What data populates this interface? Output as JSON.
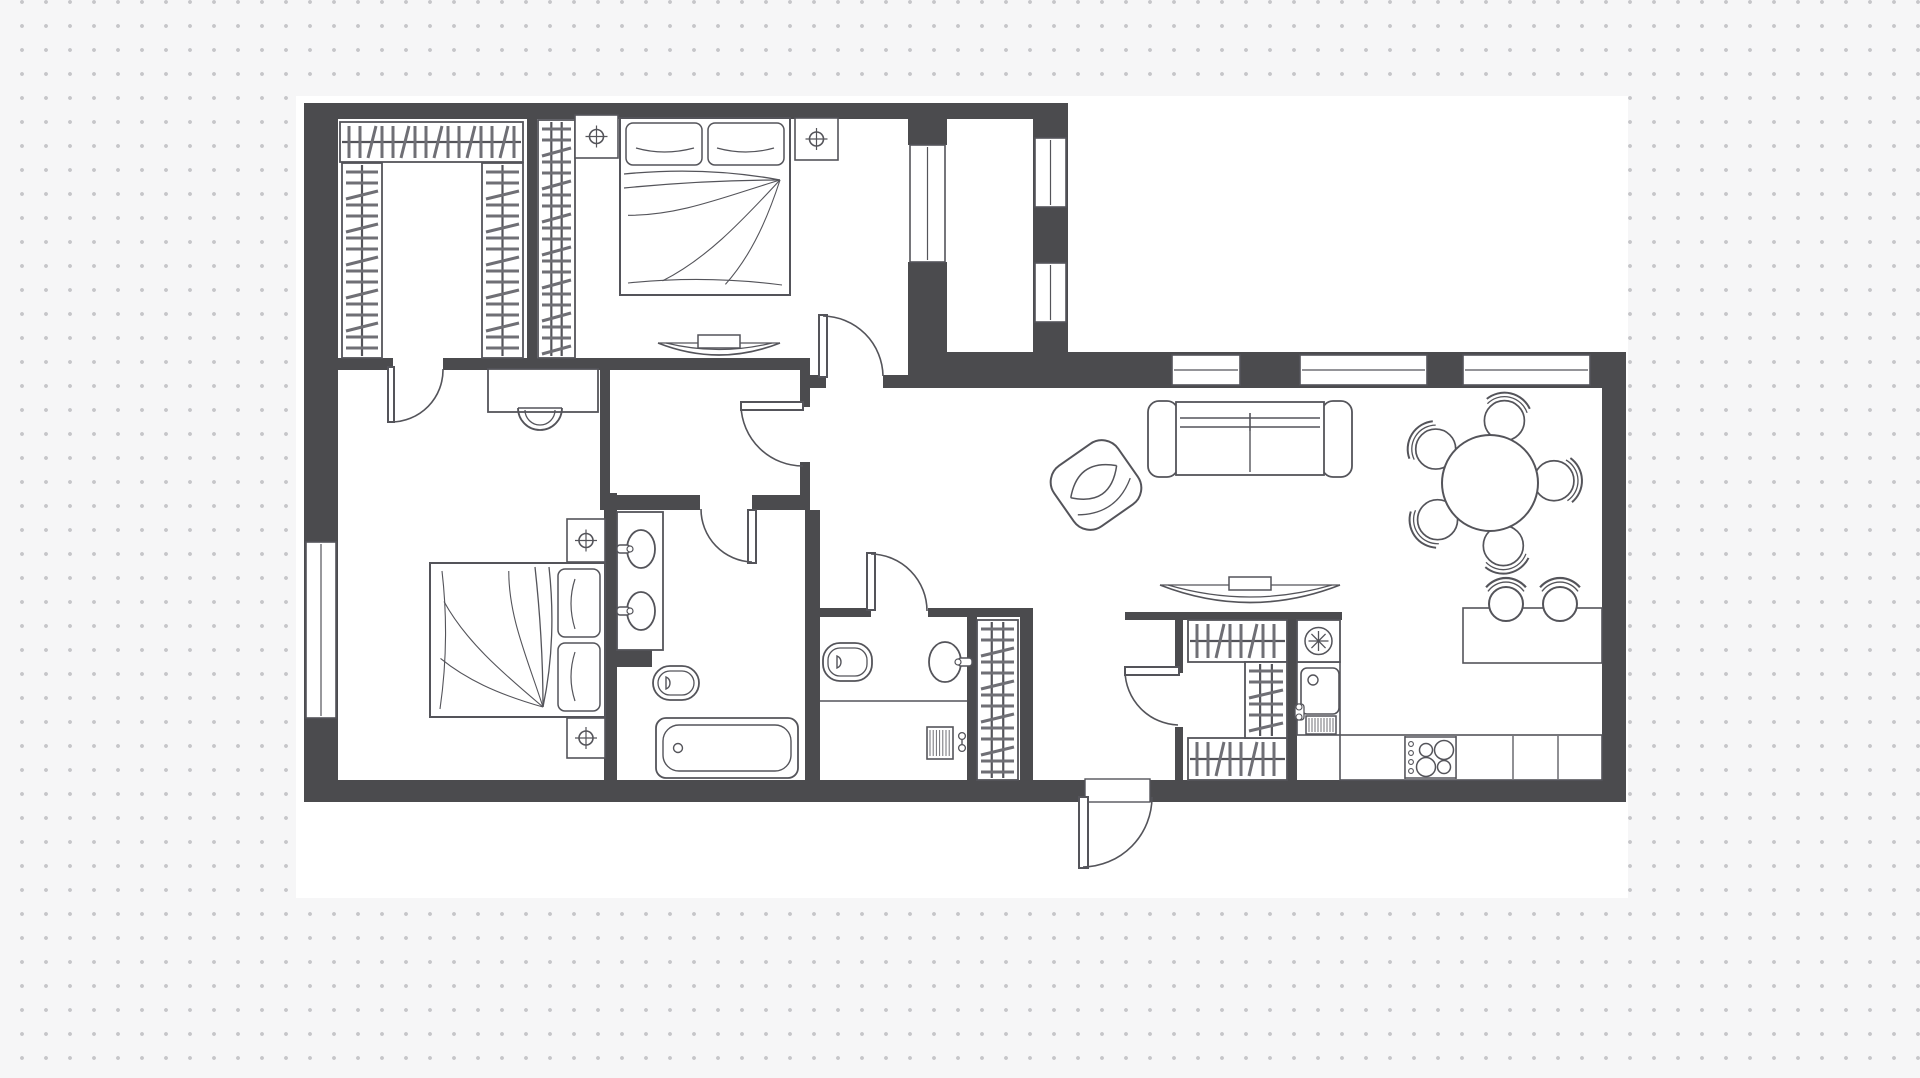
{
  "colors": {
    "background": "#f6f6f7",
    "dot": "#c6c6c9",
    "canvas": "#ffffff",
    "wall": "#4b4b4e",
    "line": "#54545a",
    "hatch": "#6f6f75"
  },
  "plan": {
    "canvas": [
      296,
      96,
      1332,
      802
    ],
    "walls": [
      [
        304,
        103,
        764,
        16
      ],
      [
        304,
        103,
        34,
        699
      ],
      [
        304,
        780,
        781,
        22
      ],
      [
        1150,
        780,
        476,
        22
      ],
      [
        1602,
        352,
        24,
        450
      ],
      [
        908,
        352,
        718,
        36
      ],
      [
        1033,
        119,
        35,
        233
      ],
      [
        908,
        119,
        39,
        26
      ],
      [
        908,
        262,
        39,
        96
      ],
      [
        338,
        358,
        55,
        12
      ],
      [
        443,
        358,
        367,
        12
      ],
      [
        810,
        375,
        16,
        13
      ],
      [
        883,
        375,
        25,
        13
      ],
      [
        800,
        370,
        10,
        37
      ],
      [
        800,
        462,
        10,
        48
      ],
      [
        527,
        119,
        10,
        239
      ],
      [
        600,
        370,
        10,
        125
      ],
      [
        604,
        493,
        13,
        289
      ],
      [
        600,
        495,
        100,
        15
      ],
      [
        752,
        495,
        58,
        15
      ],
      [
        805,
        510,
        15,
        270
      ],
      [
        607,
        648,
        45,
        19
      ],
      [
        820,
        608,
        51,
        9
      ],
      [
        928,
        608,
        105,
        9
      ],
      [
        967,
        617,
        10,
        163
      ],
      [
        1020,
        617,
        13,
        163
      ],
      [
        1125,
        612,
        217,
        8
      ],
      [
        1175,
        620,
        8,
        53
      ],
      [
        1175,
        727,
        8,
        53
      ],
      [
        1287,
        620,
        10,
        160
      ]
    ],
    "windows": [
      {
        "name": "window-left-bedroom",
        "rect": [
          306,
          542,
          30,
          176
        ],
        "axis": "v"
      },
      {
        "name": "window-bedroom-balcony",
        "rect": [
          910,
          145,
          35,
          117
        ],
        "axis": "v"
      },
      {
        "name": "window-balcony-upper",
        "rect": [
          1035,
          138,
          31,
          69
        ],
        "axis": "v"
      },
      {
        "name": "window-balcony-lower",
        "rect": [
          1035,
          263,
          31,
          59
        ],
        "axis": "v"
      },
      {
        "name": "window-living-1",
        "rect": [
          1172,
          355,
          68,
          30
        ],
        "axis": "h"
      },
      {
        "name": "window-living-2",
        "rect": [
          1300,
          355,
          127,
          30
        ],
        "axis": "h"
      },
      {
        "name": "window-living-3",
        "rect": [
          1463,
          355,
          127,
          30
        ],
        "axis": "h"
      }
    ],
    "opening": {
      "name": "entrance-threshold",
      "rect": [
        1085,
        779,
        65,
        23
      ]
    },
    "doors": [
      {
        "name": "door-walkin-closet",
        "leaf": [
          388,
          367,
          6,
          55
        ],
        "arc": [
          391,
          422,
          52,
          443,
          369,
          0
        ]
      },
      {
        "name": "door-master-bedroom",
        "leaf": [
          819,
          315,
          8,
          62
        ],
        "arc": [
          823,
          316,
          61,
          883,
          376,
          1
        ]
      },
      {
        "name": "door-vestibule",
        "leaf": [
          741,
          402,
          62,
          8
        ],
        "arc": [
          741,
          406,
          62,
          803,
          466,
          0
        ]
      },
      {
        "name": "door-bathroom",
        "leaf": [
          748,
          510,
          8,
          53
        ],
        "arc": [
          752,
          562,
          53,
          701,
          509,
          1
        ]
      },
      {
        "name": "door-wc",
        "leaf": [
          867,
          553,
          8,
          57
        ],
        "arc": [
          871,
          554,
          57,
          927,
          611,
          1
        ]
      },
      {
        "name": "door-storage",
        "leaf": [
          1125,
          667,
          54,
          8
        ],
        "arc": [
          1125,
          671,
          55,
          1178,
          725,
          0
        ]
      },
      {
        "name": "door-entrance",
        "leaf": [
          1079,
          797,
          9,
          71
        ],
        "arc": [
          1083,
          867,
          70,
          1152,
          797,
          0
        ]
      }
    ],
    "furniture": [
      {
        "type": "shelf",
        "name": "closet-shelf-top",
        "rect": [
          340,
          122,
          183,
          40
        ],
        "axis": "h",
        "rails": 1
      },
      {
        "type": "shelf",
        "name": "closet-shelf-left",
        "rect": [
          342,
          163,
          40,
          195
        ],
        "axis": "v",
        "rails": 1
      },
      {
        "type": "shelf",
        "name": "closet-shelf-right",
        "rect": [
          482,
          163,
          41,
          195
        ],
        "axis": "v",
        "rails": 1
      },
      {
        "type": "shelf",
        "name": "master-wardrobe",
        "rect": [
          538,
          120,
          37,
          238
        ],
        "axis": "v",
        "rails": 2
      },
      {
        "type": "shelf",
        "name": "hall-wardrobe",
        "rect": [
          977,
          620,
          41,
          160
        ],
        "axis": "v",
        "rails": 2
      },
      {
        "type": "shelf",
        "name": "storage-shelf-top",
        "rect": [
          1188,
          620,
          99,
          42
        ],
        "axis": "h",
        "rails": 1
      },
      {
        "type": "shelf",
        "name": "storage-shelf-bottom",
        "rect": [
          1188,
          738,
          99,
          42
        ],
        "axis": "h",
        "rails": 1
      },
      {
        "type": "shelf",
        "name": "storage-shelf-mid",
        "rect": [
          1245,
          662,
          42,
          76
        ],
        "axis": "v",
        "rails": 2
      },
      {
        "type": "bed",
        "name": "bed-master",
        "rect": [
          620,
          118,
          170,
          177
        ],
        "rot": 0
      },
      {
        "type": "bed",
        "name": "bed-second",
        "rect": [
          430,
          563,
          175,
          154
        ],
        "rot": 90
      },
      {
        "type": "nightstand",
        "name": "nightstand",
        "rect": [
          575,
          115,
          43,
          43
        ]
      },
      {
        "type": "nightstand",
        "name": "nightstand",
        "rect": [
          795,
          118,
          43,
          42
        ]
      },
      {
        "type": "nightstand",
        "name": "nightstand",
        "rect": [
          567,
          519,
          38,
          43
        ]
      },
      {
        "type": "nightstand",
        "name": "nightstand",
        "rect": [
          567,
          718,
          38,
          40
        ]
      },
      {
        "type": "desk",
        "name": "desk",
        "rect": [
          488,
          369,
          110,
          43
        ]
      },
      {
        "type": "deskchair",
        "name": "desk-chair",
        "cx": 540,
        "cy": 412,
        "r": 22
      },
      {
        "type": "console",
        "name": "tv-console-bedroom",
        "rect": [
          658,
          338,
          122,
          19
        ]
      },
      {
        "type": "console",
        "name": "tv-console-living",
        "rect": [
          1160,
          580,
          180,
          30
        ]
      },
      {
        "type": "sofa",
        "name": "sofa",
        "rect": [
          1148,
          400,
          204,
          78
        ]
      },
      {
        "type": "armchair",
        "name": "armchair",
        "cx": 1096,
        "cy": 485,
        "rot": -35
      },
      {
        "type": "dining",
        "name": "dining-table",
        "cx": 1490,
        "cy": 483,
        "r": 48,
        "chairs": [
          283,
          212,
          358,
          145,
          78
        ]
      },
      {
        "type": "vanity",
        "name": "bathroom-vanity",
        "rect": [
          617,
          512,
          46,
          138
        ]
      },
      {
        "type": "bidet",
        "name": "bidet",
        "rect": [
          653,
          666,
          46,
          34
        ]
      },
      {
        "type": "tub",
        "name": "bathtub",
        "rect": [
          656,
          718,
          142,
          60
        ]
      },
      {
        "type": "toilet",
        "name": "toilet",
        "rect": [
          823,
          643,
          49,
          38
        ]
      },
      {
        "type": "basin",
        "name": "wc-basin",
        "cx": 945,
        "cy": 662,
        "rx": 16,
        "ry": 20
      },
      {
        "type": "hline",
        "name": "wc-floor-line",
        "pts": [
          820,
          701,
          967,
          701
        ]
      },
      {
        "type": "washer",
        "name": "washer-hookup",
        "rect": [
          927,
          727,
          26,
          32
        ]
      },
      {
        "type": "counter",
        "name": "kitchen-counter-left",
        "rect": [
          1297,
          662,
          43,
          73
        ],
        "divs": []
      },
      {
        "type": "fridge",
        "name": "fridge",
        "rect": [
          1297,
          620,
          43,
          42
        ]
      },
      {
        "type": "ksink",
        "name": "kitchen-sink",
        "rect": [
          1301,
          668,
          38,
          46
        ]
      },
      {
        "type": "radiator",
        "name": "dishwasher",
        "rect": [
          1306,
          716,
          30,
          18
        ]
      },
      {
        "type": "counter",
        "name": "kitchen-counter-bottom",
        "rect": [
          1340,
          735,
          262,
          45
        ],
        "divs": [
          1405,
          1456,
          1513,
          1558
        ]
      },
      {
        "type": "hob",
        "name": "cooktop",
        "rect": [
          1405,
          737,
          51,
          41
        ]
      },
      {
        "type": "bar",
        "name": "bar-counter",
        "rect": [
          1463,
          608,
          139,
          55
        ]
      },
      {
        "type": "stool",
        "name": "bar-stool",
        "cx": 1506,
        "cy": 604,
        "r": 17
      },
      {
        "type": "stool",
        "name": "bar-stool",
        "cx": 1560,
        "cy": 604,
        "r": 17
      }
    ]
  }
}
